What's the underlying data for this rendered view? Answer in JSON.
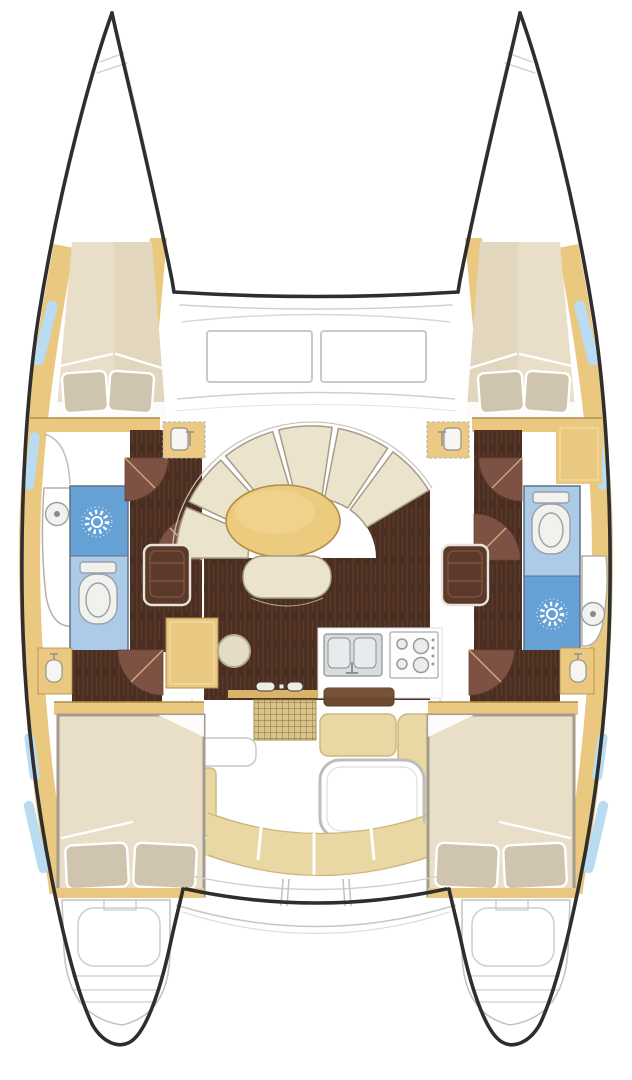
{
  "page": {
    "aria_label": "Top-down interior deck plan of a sailing catamaran",
    "background": "#ffffff",
    "text_labels_visible": "none"
  },
  "palette": {
    "white": "#ffffff",
    "hull_outline": "#2e2e2e",
    "deck_line": "#cfcfcf",
    "wood": "#eac87f",
    "wood_dark": "#b08e48",
    "wood_deep": "#d9b368",
    "bed_cream": "#e9dfc9",
    "bed_shade": "#ddd1b7",
    "pillow": "#cfc5ae",
    "floor_wenge": "#4a2e22",
    "floor_streak": "#5e3b2a",
    "door_leaf": "#7d5244",
    "door_arc_line": "#d2b078",
    "shower_blue": "#66a1d6",
    "toilet_blue": "#abcbe9",
    "window_blue": "#b9dcf2",
    "fixture_white": "#f1f1ee",
    "fixture_line": "#9aa0a6",
    "settee_cream": "#ece3cd",
    "settee_line": "#a59d89",
    "table_tan": "#ecca7e",
    "table_line": "#b28d45",
    "cushion_beige": "#e9d8a3",
    "cushion_line": "#c9b77e",
    "grate_tan": "#d8c38c",
    "grate_line": "#8a6f3c",
    "steel": "#d9dbdc",
    "steel_line": "#8d9194",
    "step_dark": "#5b3a2b",
    "step_line": "#7a523c"
  },
  "regions": {
    "bows": [
      "port-bow",
      "starboard-bow"
    ],
    "forward_cabins": [
      {
        "side": "port",
        "features": [
          "double-bed",
          "two-pillows",
          "hull-windows",
          "wood-trim"
        ]
      },
      {
        "side": "starboard",
        "features": [
          "double-bed",
          "two-pillows",
          "hull-windows",
          "wood-trim"
        ]
      }
    ],
    "heads": [
      {
        "side": "port",
        "top_to_bottom": [
          "washbasin",
          "shower",
          "toilet"
        ]
      },
      {
        "side": "starboard",
        "top_to_bottom": [
          "toilet",
          "shower",
          "washbasin"
        ]
      }
    ],
    "salon": {
      "settee_cushion_count": 6,
      "table_shape": "oval",
      "extras": [
        "bench-seat",
        "entry-steps-port",
        "entry-steps-starboard",
        "nav-cabinet",
        "round-stool"
      ]
    },
    "galley": {
      "appliances": [
        "double-sink-with-faucet",
        "four-burner-stove"
      ]
    },
    "cockpit": {
      "features": [
        "deck-grating",
        "white-table",
        "l-shaped-bench",
        "aft-curved-bench",
        "side-bench"
      ]
    },
    "aft_cabins": [
      {
        "side": "port",
        "features": [
          "double-bed",
          "two-pillows",
          "hull-windows",
          "vanity-sink"
        ]
      },
      {
        "side": "starboard",
        "features": [
          "double-bed",
          "two-pillows",
          "hull-windows",
          "vanity-sink"
        ]
      }
    ],
    "transoms": [
      "port-swim-steps",
      "starboard-swim-steps"
    ],
    "icons": {
      "shower-drain-icon": "sunburst",
      "toilet-icon": "bowl-with-tank",
      "basin-icon": "circle-with-drain-dot",
      "faucet-icon": "t-shape"
    }
  }
}
